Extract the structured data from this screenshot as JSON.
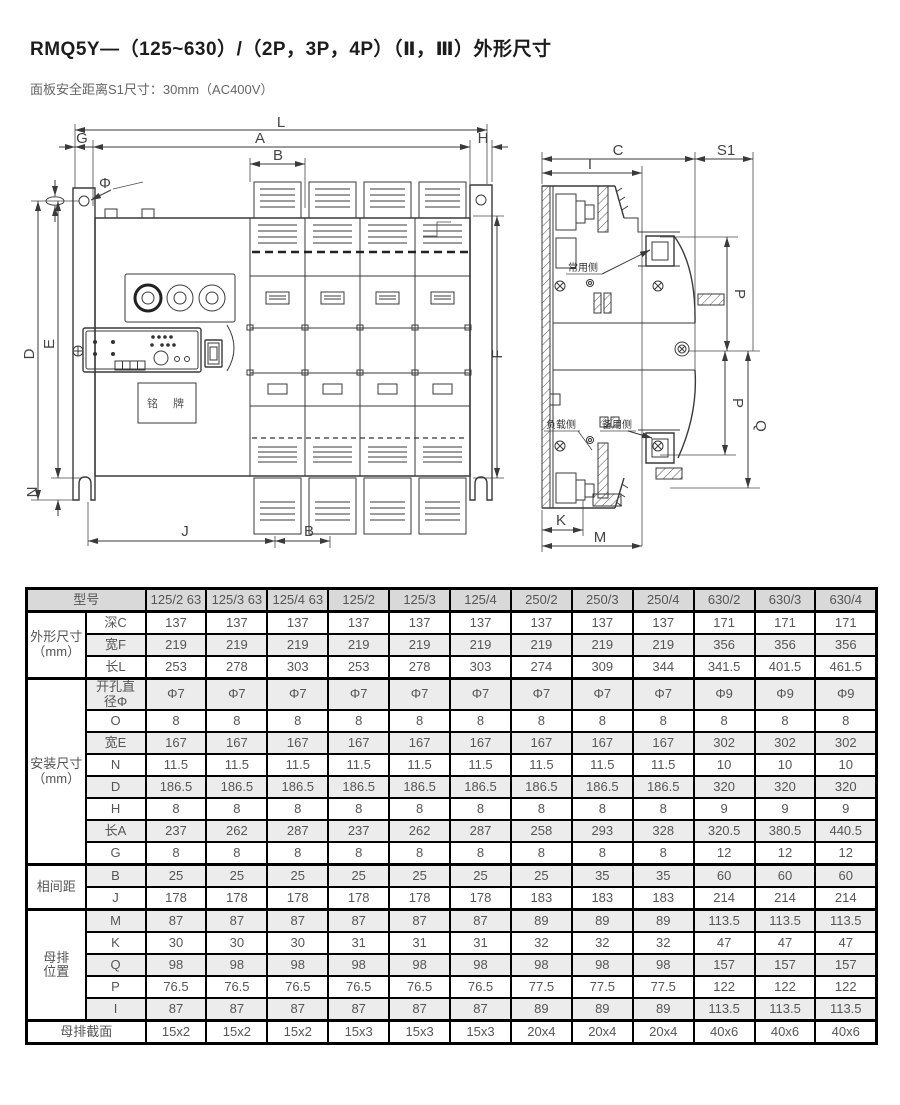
{
  "page": {
    "title": "RMQ5Y—（125~630）/（2P，3P，4P）（Ⅱ，Ⅲ）外形尺寸",
    "subtitle": "面板安全距离S1尺寸：30mm（AC400V）"
  },
  "front_view": {
    "dims": {
      "L": "L",
      "A": "A",
      "B_top": "B",
      "G": "G",
      "H": "H",
      "phi": "Φ",
      "D": "D",
      "E": "E",
      "N": "N",
      "F": "F",
      "J": "J",
      "B_bottom": "B"
    },
    "nameplate": "铭 牌"
  },
  "side_view": {
    "dims": {
      "C": "C",
      "I": "I",
      "S1": "S1",
      "P_upper": "P",
      "P_lower": "P",
      "Q": "Q",
      "K": "K",
      "M": "M"
    },
    "labels": {
      "normal_side": "常用侧",
      "load_side": "负载侧",
      "standby_side": "备用侧"
    }
  },
  "table": {
    "model_header": "型号",
    "columns": [
      "125/2 63",
      "125/3 63",
      "125/4 63",
      "125/2",
      "125/3",
      "125/4",
      "250/2",
      "250/3",
      "250/4",
      "630/2",
      "630/3",
      "630/4"
    ],
    "groups": [
      {
        "label": "外形尺寸\n（mm）",
        "rows": [
          {
            "label": "深C",
            "values": [
              "137",
              "137",
              "137",
              "137",
              "137",
              "137",
              "137",
              "137",
              "137",
              "171",
              "171",
              "171"
            ]
          },
          {
            "label": "宽F",
            "values": [
              "219",
              "219",
              "219",
              "219",
              "219",
              "219",
              "219",
              "219",
              "219",
              "356",
              "356",
              "356"
            ]
          },
          {
            "label": "长L",
            "values": [
              "253",
              "278",
              "303",
              "253",
              "278",
              "303",
              "274",
              "309",
              "344",
              "341.5",
              "401.5",
              "461.5"
            ]
          }
        ]
      },
      {
        "label": "安装尺寸\n（mm）",
        "rows": [
          {
            "label": "开孔直\n径Φ",
            "values": [
              "Φ7",
              "Φ7",
              "Φ7",
              "Φ7",
              "Φ7",
              "Φ7",
              "Φ7",
              "Φ7",
              "Φ7",
              "Φ9",
              "Φ9",
              "Φ9"
            ]
          },
          {
            "label": "O",
            "values": [
              "8",
              "8",
              "8",
              "8",
              "8",
              "8",
              "8",
              "8",
              "8",
              "8",
              "8",
              "8"
            ]
          },
          {
            "label": "宽E",
            "values": [
              "167",
              "167",
              "167",
              "167",
              "167",
              "167",
              "167",
              "167",
              "167",
              "302",
              "302",
              "302"
            ]
          },
          {
            "label": "N",
            "values": [
              "11.5",
              "11.5",
              "11.5",
              "11.5",
              "11.5",
              "11.5",
              "11.5",
              "11.5",
              "11.5",
              "10",
              "10",
              "10"
            ]
          },
          {
            "label": "D",
            "values": [
              "186.5",
              "186.5",
              "186.5",
              "186.5",
              "186.5",
              "186.5",
              "186.5",
              "186.5",
              "186.5",
              "320",
              "320",
              "320"
            ]
          },
          {
            "label": "H",
            "values": [
              "8",
              "8",
              "8",
              "8",
              "8",
              "8",
              "8",
              "8",
              "8",
              "9",
              "9",
              "9"
            ]
          },
          {
            "label": "长A",
            "values": [
              "237",
              "262",
              "287",
              "237",
              "262",
              "287",
              "258",
              "293",
              "328",
              "320.5",
              "380.5",
              "440.5"
            ]
          },
          {
            "label": "G",
            "values": [
              "8",
              "8",
              "8",
              "8",
              "8",
              "8",
              "8",
              "8",
              "8",
              "12",
              "12",
              "12"
            ]
          }
        ]
      },
      {
        "label": "相间距",
        "rows": [
          {
            "label": "B",
            "values": [
              "25",
              "25",
              "25",
              "25",
              "25",
              "25",
              "25",
              "35",
              "35",
              "60",
              "60",
              "60"
            ]
          },
          {
            "label": "J",
            "values": [
              "178",
              "178",
              "178",
              "178",
              "178",
              "178",
              "183",
              "183",
              "183",
              "214",
              "214",
              "214"
            ]
          }
        ]
      },
      {
        "label": "母排\n位置",
        "rows": [
          {
            "label": "M",
            "values": [
              "87",
              "87",
              "87",
              "87",
              "87",
              "87",
              "89",
              "89",
              "89",
              "113.5",
              "113.5",
              "113.5"
            ]
          },
          {
            "label": "K",
            "values": [
              "30",
              "30",
              "30",
              "31",
              "31",
              "31",
              "32",
              "32",
              "32",
              "47",
              "47",
              "47"
            ]
          },
          {
            "label": "Q",
            "values": [
              "98",
              "98",
              "98",
              "98",
              "98",
              "98",
              "98",
              "98",
              "98",
              "157",
              "157",
              "157"
            ]
          },
          {
            "label": "P",
            "values": [
              "76.5",
              "76.5",
              "76.5",
              "76.5",
              "76.5",
              "76.5",
              "77.5",
              "77.5",
              "77.5",
              "122",
              "122",
              "122"
            ]
          },
          {
            "label": "I",
            "values": [
              "87",
              "87",
              "87",
              "87",
              "87",
              "87",
              "89",
              "89",
              "89",
              "113.5",
              "113.5",
              "113.5"
            ]
          }
        ]
      }
    ],
    "footer": {
      "label": "母排截面",
      "values": [
        "15x2",
        "15x2",
        "15x2",
        "15x3",
        "15x3",
        "15x3",
        "20x4",
        "20x4",
        "20x4",
        "40x6",
        "40x6",
        "40x6"
      ]
    }
  }
}
